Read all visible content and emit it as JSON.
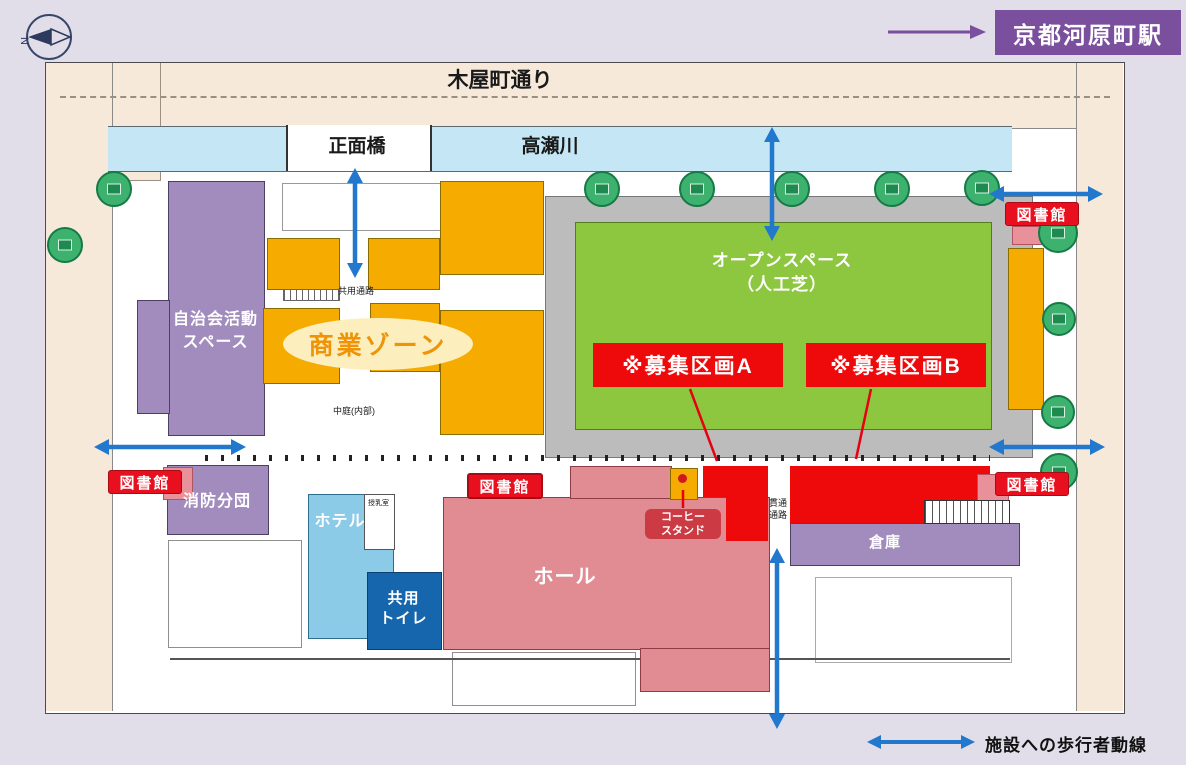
{
  "colors": {
    "accent_red": "#ee0a0a",
    "badge_red": "#e8101e",
    "arrow_blue": "#2278cc",
    "station_purple": "#7a4f9d",
    "building_purple": "#a18cbd",
    "commercial_orange": "#f6ab00",
    "hall_pink": "#e18b93",
    "hotel_blue": "#8bcbe7",
    "toilet_blue": "#1666ae",
    "river_blue": "#c5e7f5",
    "turf_green": "#8dc63f",
    "street_cream": "#f6e9da",
    "tree_green": "#3db26e"
  },
  "header": {
    "station_label": "京都河原町駅",
    "compass_letter": "N"
  },
  "legend": {
    "label": "施設への歩行者動線"
  },
  "map": {
    "street_top": "木屋町通り",
    "river": "高瀬川",
    "bridge": "正面橋",
    "open_space_line1": "オープンスペース",
    "open_space_line2": "（人工芝）",
    "zone_a": "※募集区画A",
    "zone_b": "※募集区画B",
    "library": "図書館",
    "jichikai_line1": "自治会活動",
    "jichikai_line2": "スペース",
    "commercial": "商業ゾーン",
    "kyoyo_tsuro": "共用通路",
    "nakaniwa": "中庭(内部)",
    "shobo": "消防分団",
    "hotel": "ホテル",
    "junyu": "授乳室",
    "toilet_line1": "共用",
    "toilet_line2": "トイレ",
    "hall": "ホール",
    "coffee_line1": "コーヒー",
    "coffee_line2": "スタンド",
    "kantsu_line1": "貫通",
    "kantsu_line2": "通路",
    "soko": "倉庫"
  }
}
